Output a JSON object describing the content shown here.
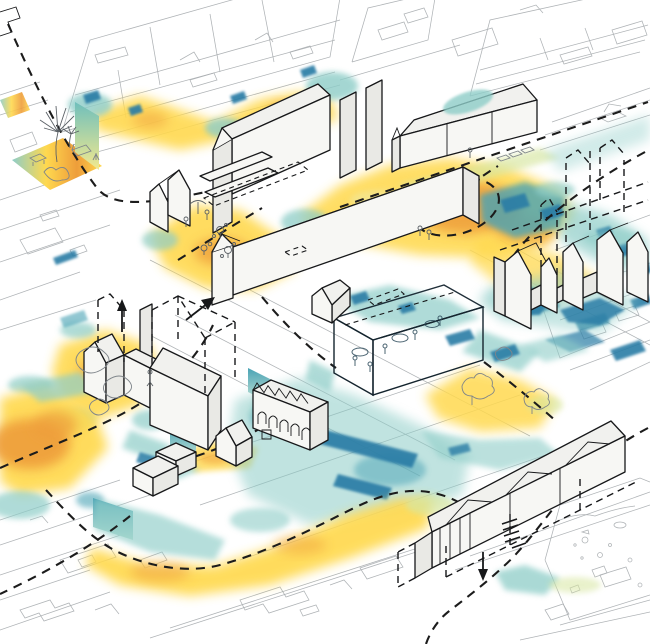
{
  "figure": {
    "kind": "axonometric-urban-masterplan-diagram",
    "visible_text": "",
    "notes_icons": [
      "palm-tree-icon",
      "plant-icon",
      "lounge-chair-icon",
      "umbrella-icon",
      "person-icon",
      "cafe-table-icon",
      "tree-icon",
      "car-icon",
      "arrow-up-icon",
      "arrow-diagonal-icon",
      "arrow-down-icon",
      "dashed-route",
      "dashed-ghost-volume",
      "dashed-circle-marker",
      "hatch-marker"
    ]
  },
  "palette": {
    "background": "#ffffff",
    "context_linework": "#a8acb0",
    "outline_black": "#17181a",
    "building_fill": "#f7f7f4",
    "building_side": "#e9e9e5",
    "roof_fill": "#f1f1ee",
    "sketch_gray": "#7f858a",
    "route_dash": "#1c1c1c",
    "heat_hot": "#ee9d3a",
    "heat_warm": "#ffd94f",
    "heat_pale": "#efe9a0",
    "heat_green": "#d7e6a0",
    "heat_cool": "#8ecdc8",
    "heat_cold": "#4aa3b5",
    "heat_deep": "#2a7da6",
    "glass_top": "#a9cadb",
    "glass_front": "#7fafc9",
    "glass_side": "#8fbacf"
  },
  "gradients": {
    "park_floor": [
      "#8ecdc8",
      "#ffe34f",
      "#f2a83e",
      "#ffd94f"
    ],
    "curtain_top": "#6fbfbc",
    "curtain_bottom": "#f3e98e"
  }
}
